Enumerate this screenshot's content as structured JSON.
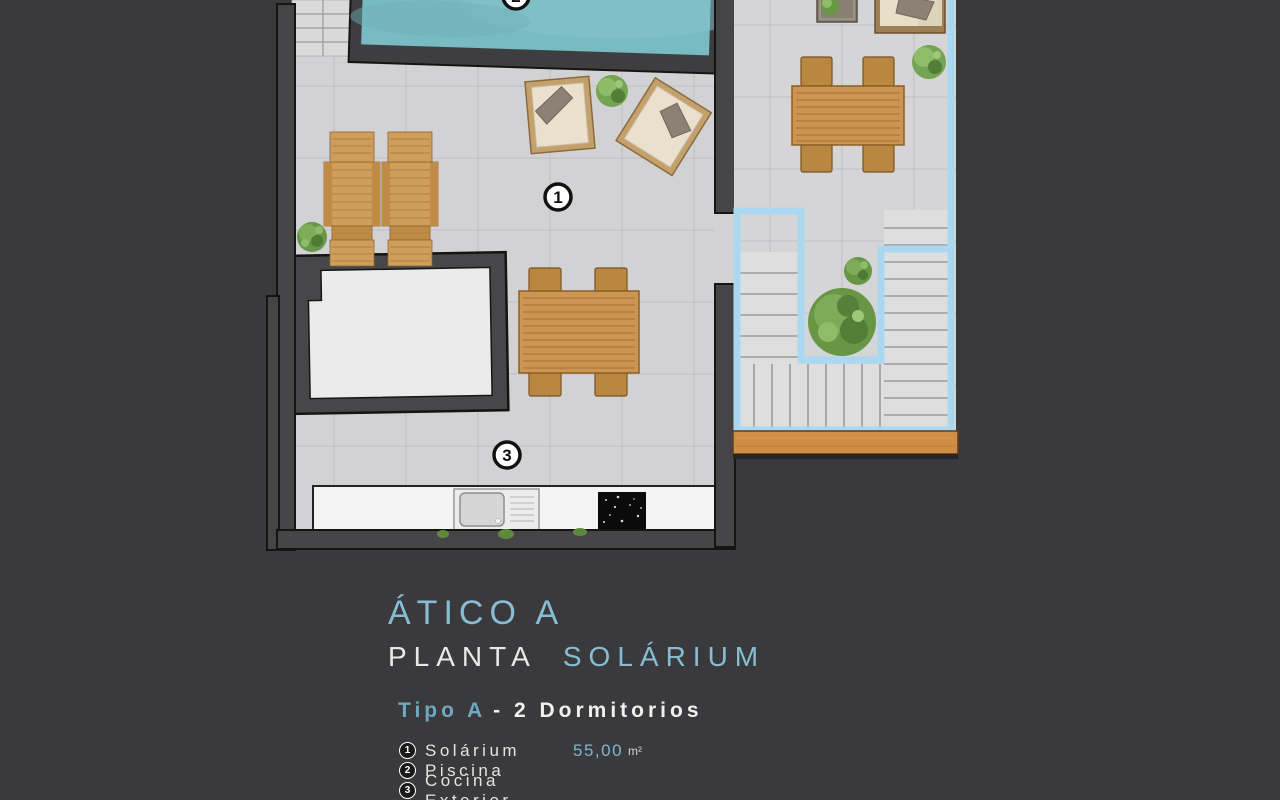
{
  "titles": {
    "line1": "ÁTICO A",
    "line2_left": "PLANTA",
    "line2_right": "SOLÁRIUM",
    "line3_accent": "Tipo A",
    "line3_rest": "- 2  Dormitorios"
  },
  "legend": {
    "items": [
      {
        "num": "1",
        "label": "Solárium",
        "area": "55,00",
        "unit": "m²"
      },
      {
        "num": "2",
        "label": "Piscina",
        "area": "",
        "unit": ""
      },
      {
        "num": "3",
        "label": "Cocina Exterior",
        "area": "",
        "unit": ""
      }
    ]
  },
  "plan": {
    "markers": [
      {
        "num": "1",
        "label": "Solárium"
      },
      {
        "num": "2",
        "label": "Piscina"
      },
      {
        "num": "3",
        "label": "Cocina Exterior"
      }
    ]
  },
  "colors": {
    "background": "#3a3a3c",
    "accent_blue": "#87bdd3",
    "accent_blue_bold": "#6fa8c4",
    "pool_water": "#79bbc3",
    "neighbor_outline_blue": "#abd8f1",
    "tile_floor": "#d2d2d4",
    "wall_dark": "#454547",
    "wood_furniture": "#cc9552",
    "wood_deck_strip": "#d08d45",
    "plant_green": "#679644",
    "counter_white": "#f4f4f4",
    "hob_black": "#0b0b0c"
  }
}
